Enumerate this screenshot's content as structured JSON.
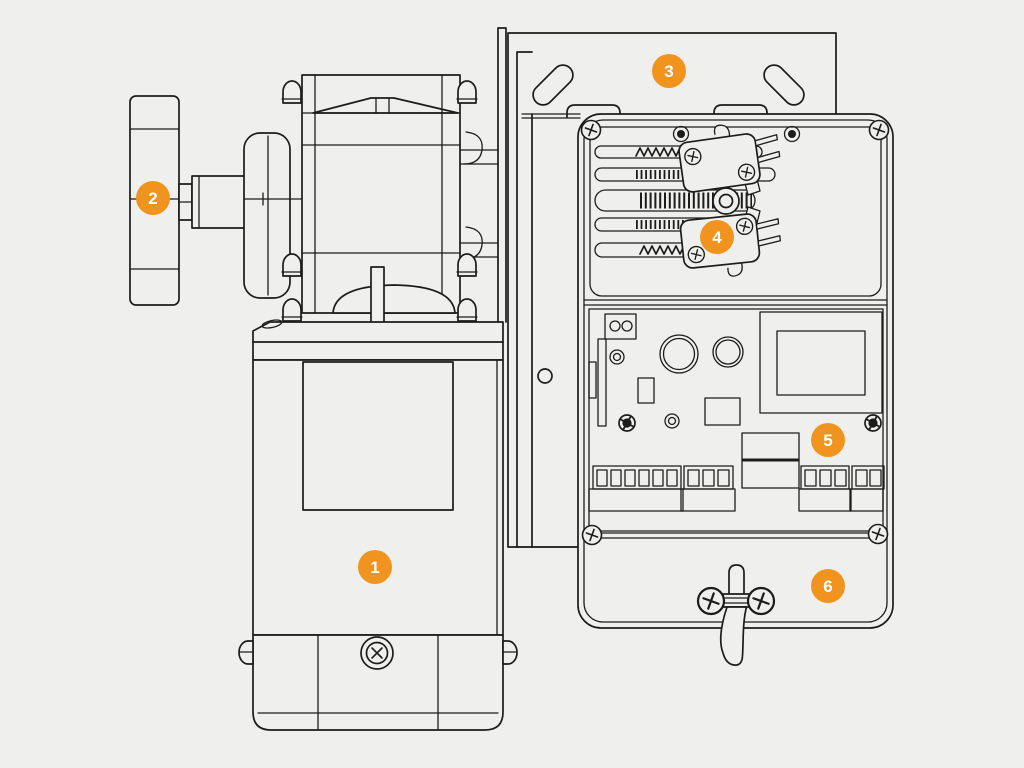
{
  "colors": {
    "bg": "#efefed",
    "line": "#1c1c1c",
    "accent": "#f0941f",
    "badge_text": "#ffffff"
  },
  "diagram": {
    "alt": "Technical exploded line drawing of a motor drive unit and control box with numbered callouts",
    "callouts": [
      {
        "number": "1"
      },
      {
        "number": "2"
      },
      {
        "number": "3"
      },
      {
        "number": "4"
      },
      {
        "number": "5"
      },
      {
        "number": "6"
      }
    ]
  }
}
